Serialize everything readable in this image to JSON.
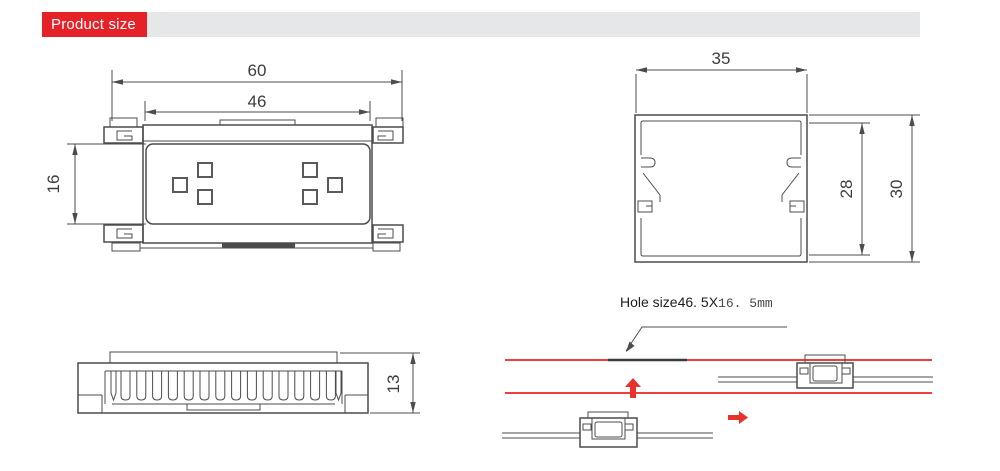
{
  "header": {
    "title": "Product size"
  },
  "colors": {
    "banner_red": "#e62229",
    "drawing_red": "#ee3f3b",
    "line_gray": "#4c4c4c",
    "bar_gray": "#e6e7e9"
  },
  "views": {
    "front": {
      "dim_overall_width": "60",
      "dim_inner_width": "46",
      "dim_window_height": "16"
    },
    "section": {
      "dim_width": "35",
      "dim_inner_height": "28",
      "dim_overall_height": "30"
    },
    "profile": {
      "dim_height": "13"
    },
    "install": {
      "hole_label_sans": "Hole size46. 5X",
      "hole_label_mono": "16. 5mm"
    }
  }
}
